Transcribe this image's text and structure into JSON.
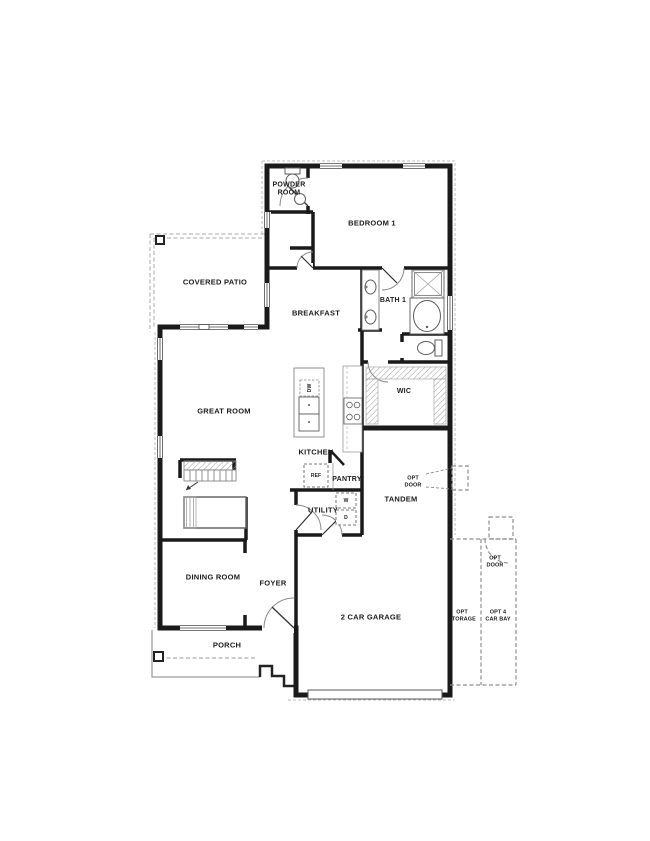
{
  "rooms": {
    "powder_room": "POWDER\nROOM",
    "bedroom_1": "BEDROOM 1",
    "covered_patio": "COVERED PATIO",
    "breakfast": "BREAKFAST",
    "bath_1": "BATH 1",
    "great_room": "GREAT ROOM",
    "wic": "WIC",
    "kitchen": "KITCHEN",
    "pantry": "PANTRY",
    "tandem": "TANDEM",
    "utility": "UTILITY",
    "dining_room": "DINING ROOM",
    "foyer": "FOYER",
    "garage": "2 CAR GARAGE",
    "porch": "PORCH"
  },
  "options": {
    "opt_door_upper": "OPT\nDOOR",
    "opt_door_lower": "OPT\nDOOR",
    "opt_storage": "OPT\nSTORAGE",
    "opt_4_car_bay": "OPT 4\nCAR BAY"
  },
  "appliances": {
    "dishwasher": "DW",
    "refrigerator": "REF",
    "washer": "W",
    "dryer": "D"
  },
  "colors": {
    "wall": "#1a1a1a",
    "fixture": "#5c5c5c",
    "dashed_optional": "#8f8f8f",
    "roof_line": "#bdbdbd",
    "background": "#ffffff",
    "label": "#1c1c1c"
  }
}
